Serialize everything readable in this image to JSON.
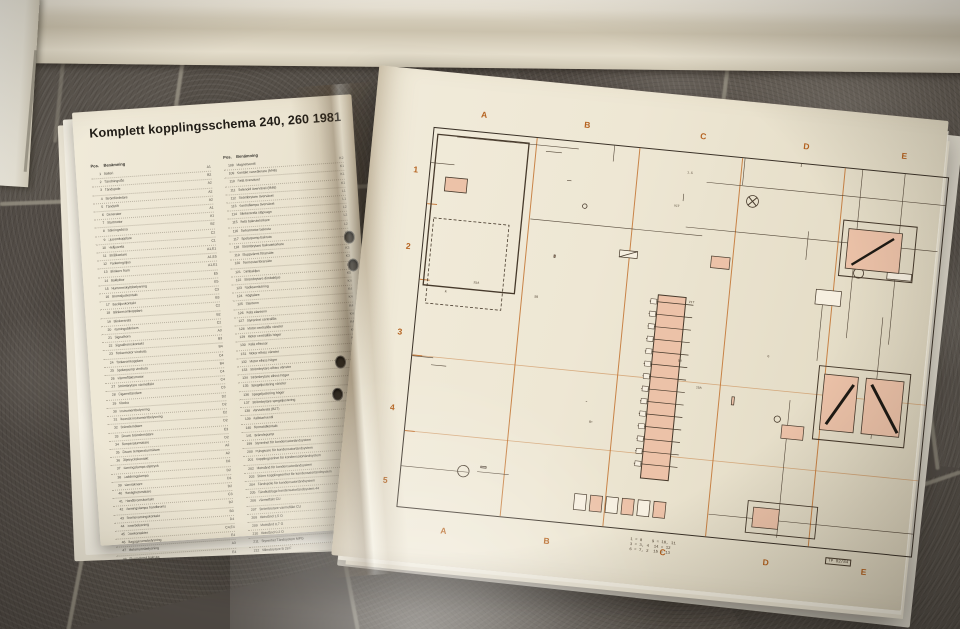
{
  "book": {
    "left_page": {
      "title": "Komplett kopplingsschema 240, 260 1981",
      "col_header_pos": "Pos.",
      "col_header_name": "Benämning",
      "footer": {
        "label": "Färgkoder på ledningar",
        "ref": "L5"
      },
      "column1": [
        [
          1,
          "Batteri",
          "A1"
        ],
        [
          2,
          "Tändningslås",
          "B2"
        ],
        [
          3,
          "Tändspole",
          "A2"
        ],
        [
          4,
          "Strömfördelare",
          "A2"
        ],
        [
          5,
          "Tändstift",
          "A2"
        ],
        [
          6,
          "Generator",
          "A1"
        ],
        [
          7,
          "Startmotor",
          "A1"
        ],
        [
          8,
          "Säkringsdosa",
          "B2"
        ],
        [
          9,
          "Ljusomkopplare",
          "C2"
        ],
        [
          10,
          "Helljusrelä",
          "C1"
        ],
        [
          11,
          "Strålkastare",
          "A1,E1"
        ],
        [
          12,
          "Parkeringsljus",
          "A1,E5"
        ],
        [
          13,
          "Blinkers fram",
          "A1,E1"
        ],
        [
          14,
          "Baklyktor",
          "E5"
        ],
        [
          15,
          "Nummerskyltsbelysning",
          "E5"
        ],
        [
          16,
          "Bromsljuskontakt",
          "C3"
        ],
        [
          17,
          "Backljuskontakt",
          "B3"
        ],
        [
          18,
          "Blinkersomkopplare",
          "C2"
        ],
        [
          19,
          "Blinkersrelä",
          "B2"
        ],
        [
          20,
          "Varningsblinkers",
          "C2"
        ],
        [
          21,
          "Signalhorn",
          "A3"
        ],
        [
          22,
          "Signalhornskontakt",
          "B3"
        ],
        [
          23,
          "Torkarmotor vindruta",
          "B4"
        ],
        [
          24,
          "Torkaromkopplare",
          "C4"
        ],
        [
          25,
          "Spolarpump vindruta",
          "B4"
        ],
        [
          26,
          "Värmefläktsmotor",
          "C4"
        ],
        [
          27,
          "Strömbrytare värmefläkt",
          "C4"
        ],
        [
          28,
          "Cigarrettändare",
          "C3"
        ],
        [
          29,
          "Klocka",
          "D2"
        ],
        [
          30,
          "Instrumentbelysning",
          "D2"
        ],
        [
          31,
          "Reostat instrumentbelysning",
          "C2"
        ],
        [
          32,
          "Bränslemätare",
          "D2"
        ],
        [
          33,
          "Givare bränslemätare",
          "E3"
        ],
        [
          34,
          "Temperaturmätare",
          "D2"
        ],
        [
          35,
          "Givare temperaturmätare",
          "A2"
        ],
        [
          36,
          "Oljetryckskontakt",
          "A2"
        ],
        [
          37,
          "Varningslampa oljetryck",
          "D2"
        ],
        [
          38,
          "Laddningslampa",
          "D2"
        ],
        [
          39,
          "Varvräknare",
          "D1"
        ],
        [
          40,
          "Hastighetsmätare",
          "D2"
        ],
        [
          41,
          "Handbromskontakt",
          "C3"
        ],
        [
          42,
          "Varningslampa handbroms",
          "D2"
        ],
        [
          43,
          "Bromsvarningskontakt",
          "B3"
        ],
        [
          44,
          "Innerbelysning",
          "D4"
        ],
        [
          45,
          "Dörrkontakter",
          "C4,E4"
        ],
        [
          46,
          "Bagagerumsbelysning",
          "E4"
        ],
        [
          47,
          "Motorrumsbelysning",
          "A3"
        ],
        [
          48,
          "Eluppvärmd bakruta",
          "E4"
        ]
      ],
      "column2": [
        [
          108,
          "Magnetventil",
          "K2"
        ],
        [
          109,
          "Kontakt varvräknare (M46)",
          "K1"
        ],
        [
          110,
          "Relä överväxel",
          "K1"
        ],
        [
          111,
          "Solenoid överväxel (M46)",
          "K1"
        ],
        [
          112,
          "Strömbrytare överväxel",
          "L1"
        ],
        [
          113,
          "Kontrollampa överväxel",
          "L1"
        ],
        [
          114,
          "Blinkersrelä släpvagn",
          "L2"
        ],
        [
          115,
          "Relä bakrutetorkare",
          "L2"
        ],
        [
          116,
          "Torkarmotor bakruta",
          "L2"
        ],
        [
          117,
          "Spolarpump bakruta",
          "L2"
        ],
        [
          118,
          "Strömbrytare bakrutetorkare",
          "L2"
        ],
        [
          119,
          "Eluppvärmt förarsäte",
          "K3"
        ],
        [
          120,
          "Termostat förarsäte",
          "K3"
        ],
        [
          121,
          "Dimbakljus",
          "L5"
        ],
        [
          122,
          "Strömbrytare dimbakljus",
          "K5"
        ],
        [
          123,
          "Radioanslutning",
          "K4"
        ],
        [
          124,
          "Högtalare",
          "K4"
        ],
        [
          125,
          "Elantenn",
          "K4"
        ],
        [
          126,
          "Relä elantenn",
          "K4"
        ],
        [
          127,
          "Styrenhet centrallås",
          "K4"
        ],
        [
          128,
          "Motor centrallås vänster",
          "K4"
        ],
        [
          129,
          "Motor centrallås höger",
          "K4"
        ],
        [
          130,
          "Relä elhissar",
          "K4"
        ],
        [
          131,
          "Motor elhiss vänster",
          "K4"
        ],
        [
          132,
          "Motor elhiss höger",
          "K4"
        ],
        [
          133,
          "Strömbrytare elhiss vänster",
          "K4"
        ],
        [
          134,
          "Strömbrytare elhiss höger",
          "K4"
        ],
        [
          135,
          "Spegeljustering vänster",
          "L4"
        ],
        [
          136,
          "Spegeljustering höger",
          "L4"
        ],
        [
          137,
          "Strömbrytare spegeljustering",
          "L4"
        ],
        [
          138,
          "Varvtalsrelä (B27)",
          "G2"
        ],
        [
          139,
          "Kallstartventil",
          "G2"
        ],
        [
          140,
          "Termotidkontakt",
          "G2"
        ],
        [
          141,
          "Bränslepump",
          "G1"
        ],
        [
          199,
          "Styrenhet för kondensatortändsystem",
          "D4"
        ],
        [
          200,
          "Pulsgivare för kondensatortändsystem",
          "D4"
        ],
        [
          201,
          "Kopplingsenhet för kondensatortändsystem",
          "G4"
        ],
        [
          202,
          "Motstånd för kondensatortändsystem",
          "F4"
        ],
        [
          203,
          "Större kopplingsenhet för kondensatortändsystem",
          "D4"
        ],
        [
          204,
          "Tändspole för kondensatortändsystem",
          "D4"
        ],
        [
          205,
          "Tändkablage kondensatortändsystem 44",
          "F4"
        ],
        [
          206,
          "Värmefläkt CU",
          "L2"
        ],
        [
          207,
          "Strömbrytare värmefläkt CU",
          "L2"
        ],
        [
          208,
          "Motstånd 1,5 Ω",
          "L2"
        ],
        [
          209,
          "Motstånd 0,7 Ω",
          "L2"
        ],
        [
          210,
          "Motstånd 0,2 Ω",
          "L2"
        ],
        [
          211,
          "Styrenhet Tändsystem MPG",
          "G3"
        ],
        [
          212,
          "Mikrobrytare B 28 F",
          "K3"
        ]
      ]
    },
    "right_page": {
      "grid_letters": [
        "A",
        "B",
        "C",
        "D",
        "E"
      ],
      "row_numbers": [
        "1",
        "2",
        "3",
        "4",
        "5"
      ],
      "legend_lines": [
        "1 = 8    9 = 10, 11",
        "3 = 3, 4  14 = 12",
        "6 = 7, 2  15 = 13"
      ],
      "plate_code": "TP 82/84",
      "accent_orange": "#c2722f",
      "component_fill": "#ecc2a8",
      "line_color": "#46392b",
      "wire_labels": [
        "15A",
        "8A",
        "16A",
        "25A",
        "30",
        "15",
        "54",
        "31",
        "58",
        "49a",
        "B+",
        "D+",
        "50",
        "SB",
        "GN",
        "BL",
        "SV",
        "R",
        "VIT",
        "GUL",
        "BR",
        "2.5",
        "1.5",
        "0.75",
        "6",
        "J",
        "K",
        "M",
        "G",
        "CU"
      ]
    }
  }
}
